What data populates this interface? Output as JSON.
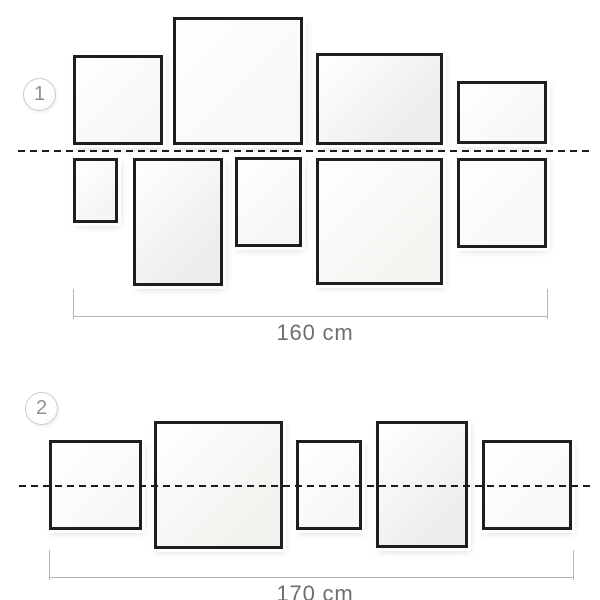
{
  "diagram": {
    "title": "picture-hanging-arrangements",
    "colors": {
      "background": "#ffffff",
      "frame_border": "#1e1e1e",
      "dashed_line": "#1c1c1c",
      "measure_line": "#b5b5b5",
      "label_text": "#6e6f6e",
      "badge_border": "#c9cccc",
      "badge_text": "#8d9191"
    },
    "groups": [
      {
        "label": "1",
        "badge": {
          "x": 23,
          "y": 78,
          "d": 33
        },
        "dashed_line": {
          "x1": 18,
          "x2": 593,
          "y": 150,
          "over_frames": false
        },
        "frames": [
          {
            "x": 73,
            "y": 55,
            "w": 90,
            "h": 90,
            "fill": "#f6f7f6"
          },
          {
            "x": 173,
            "y": 17,
            "w": 130,
            "h": 128,
            "fill": "#f8f8f6"
          },
          {
            "x": 316,
            "y": 53,
            "w": 127,
            "h": 92,
            "fill": "#ebedec"
          },
          {
            "x": 457,
            "y": 81,
            "w": 90,
            "h": 63,
            "fill": "#f6f7f6"
          },
          {
            "x": 73,
            "y": 158,
            "w": 45,
            "h": 65,
            "fill": "#f4f5f4"
          },
          {
            "x": 133,
            "y": 158,
            "w": 90,
            "h": 128,
            "fill": "#ededeb"
          },
          {
            "x": 235,
            "y": 157,
            "w": 67,
            "h": 90,
            "fill": "#f5f6f5"
          },
          {
            "x": 316,
            "y": 158,
            "w": 127,
            "h": 127,
            "fill": "#f4f4f1"
          },
          {
            "x": 457,
            "y": 158,
            "w": 90,
            "h": 90,
            "fill": "#f7f8f7"
          }
        ],
        "measure": {
          "x1": 73,
          "x2": 547,
          "y": 316,
          "tick_h": 30,
          "label": "160 cm",
          "label_x": 315,
          "label_y": 320
        }
      },
      {
        "label": "2",
        "badge": {
          "x": 25,
          "y": 392,
          "d": 33
        },
        "dashed_line": {
          "x1": 19,
          "x2": 593,
          "y": 485,
          "over_frames": true
        },
        "frames": [
          {
            "x": 49,
            "y": 440,
            "w": 93,
            "h": 90,
            "fill": "#f6f8f7"
          },
          {
            "x": 154,
            "y": 421,
            "w": 129,
            "h": 128,
            "fill": "#f2f2ef"
          },
          {
            "x": 296,
            "y": 440,
            "w": 66,
            "h": 90,
            "fill": "#f6f7f6"
          },
          {
            "x": 376,
            "y": 421,
            "w": 92,
            "h": 127,
            "fill": "#ededeb"
          },
          {
            "x": 482,
            "y": 440,
            "w": 90,
            "h": 90,
            "fill": "#f7f8f7"
          }
        ],
        "measure": {
          "x1": 49,
          "x2": 573,
          "y": 577,
          "tick_h": 30,
          "label": "170 cm",
          "label_x": 315,
          "label_y": 581
        }
      }
    ]
  }
}
